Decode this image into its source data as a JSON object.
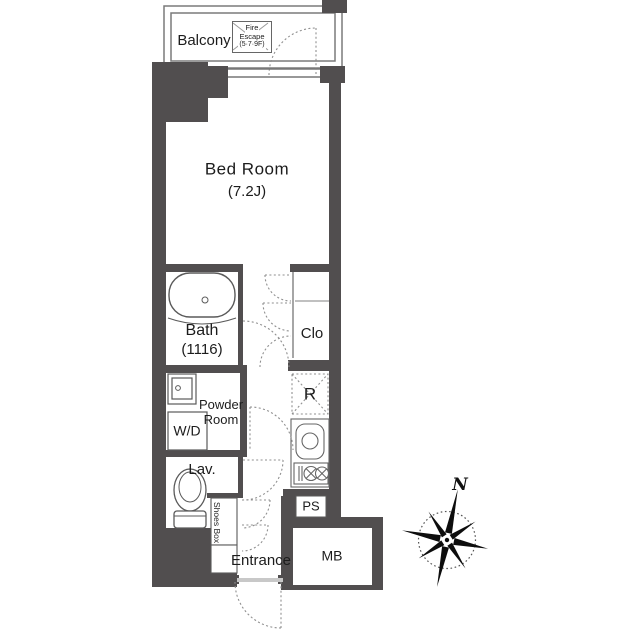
{
  "labels": {
    "balcony": "Balcony",
    "fire_escape": {
      "line1": "Fire",
      "line2": "Escape",
      "line3": "(5·7·9F)"
    },
    "bedroom": {
      "name": "Bed Room",
      "size": "(7.2J)"
    },
    "bath": {
      "name": "Bath",
      "size": "(1116)"
    },
    "closet": "Clo",
    "powder": {
      "line1": "Powder",
      "line2": "Room"
    },
    "wd": "W/D",
    "fridge": "R",
    "lav": "Lav.",
    "shoes_box": "Shoes Box",
    "entrance": "Entrance",
    "ps": "PS",
    "mb": "MB",
    "compass_north": "N"
  },
  "colors": {
    "wall": "#514e4f",
    "outline": "#5a5a5a",
    "dash": "#8f8f8f",
    "threshold": "#c8c8c8",
    "text": "#1c1c1c"
  }
}
